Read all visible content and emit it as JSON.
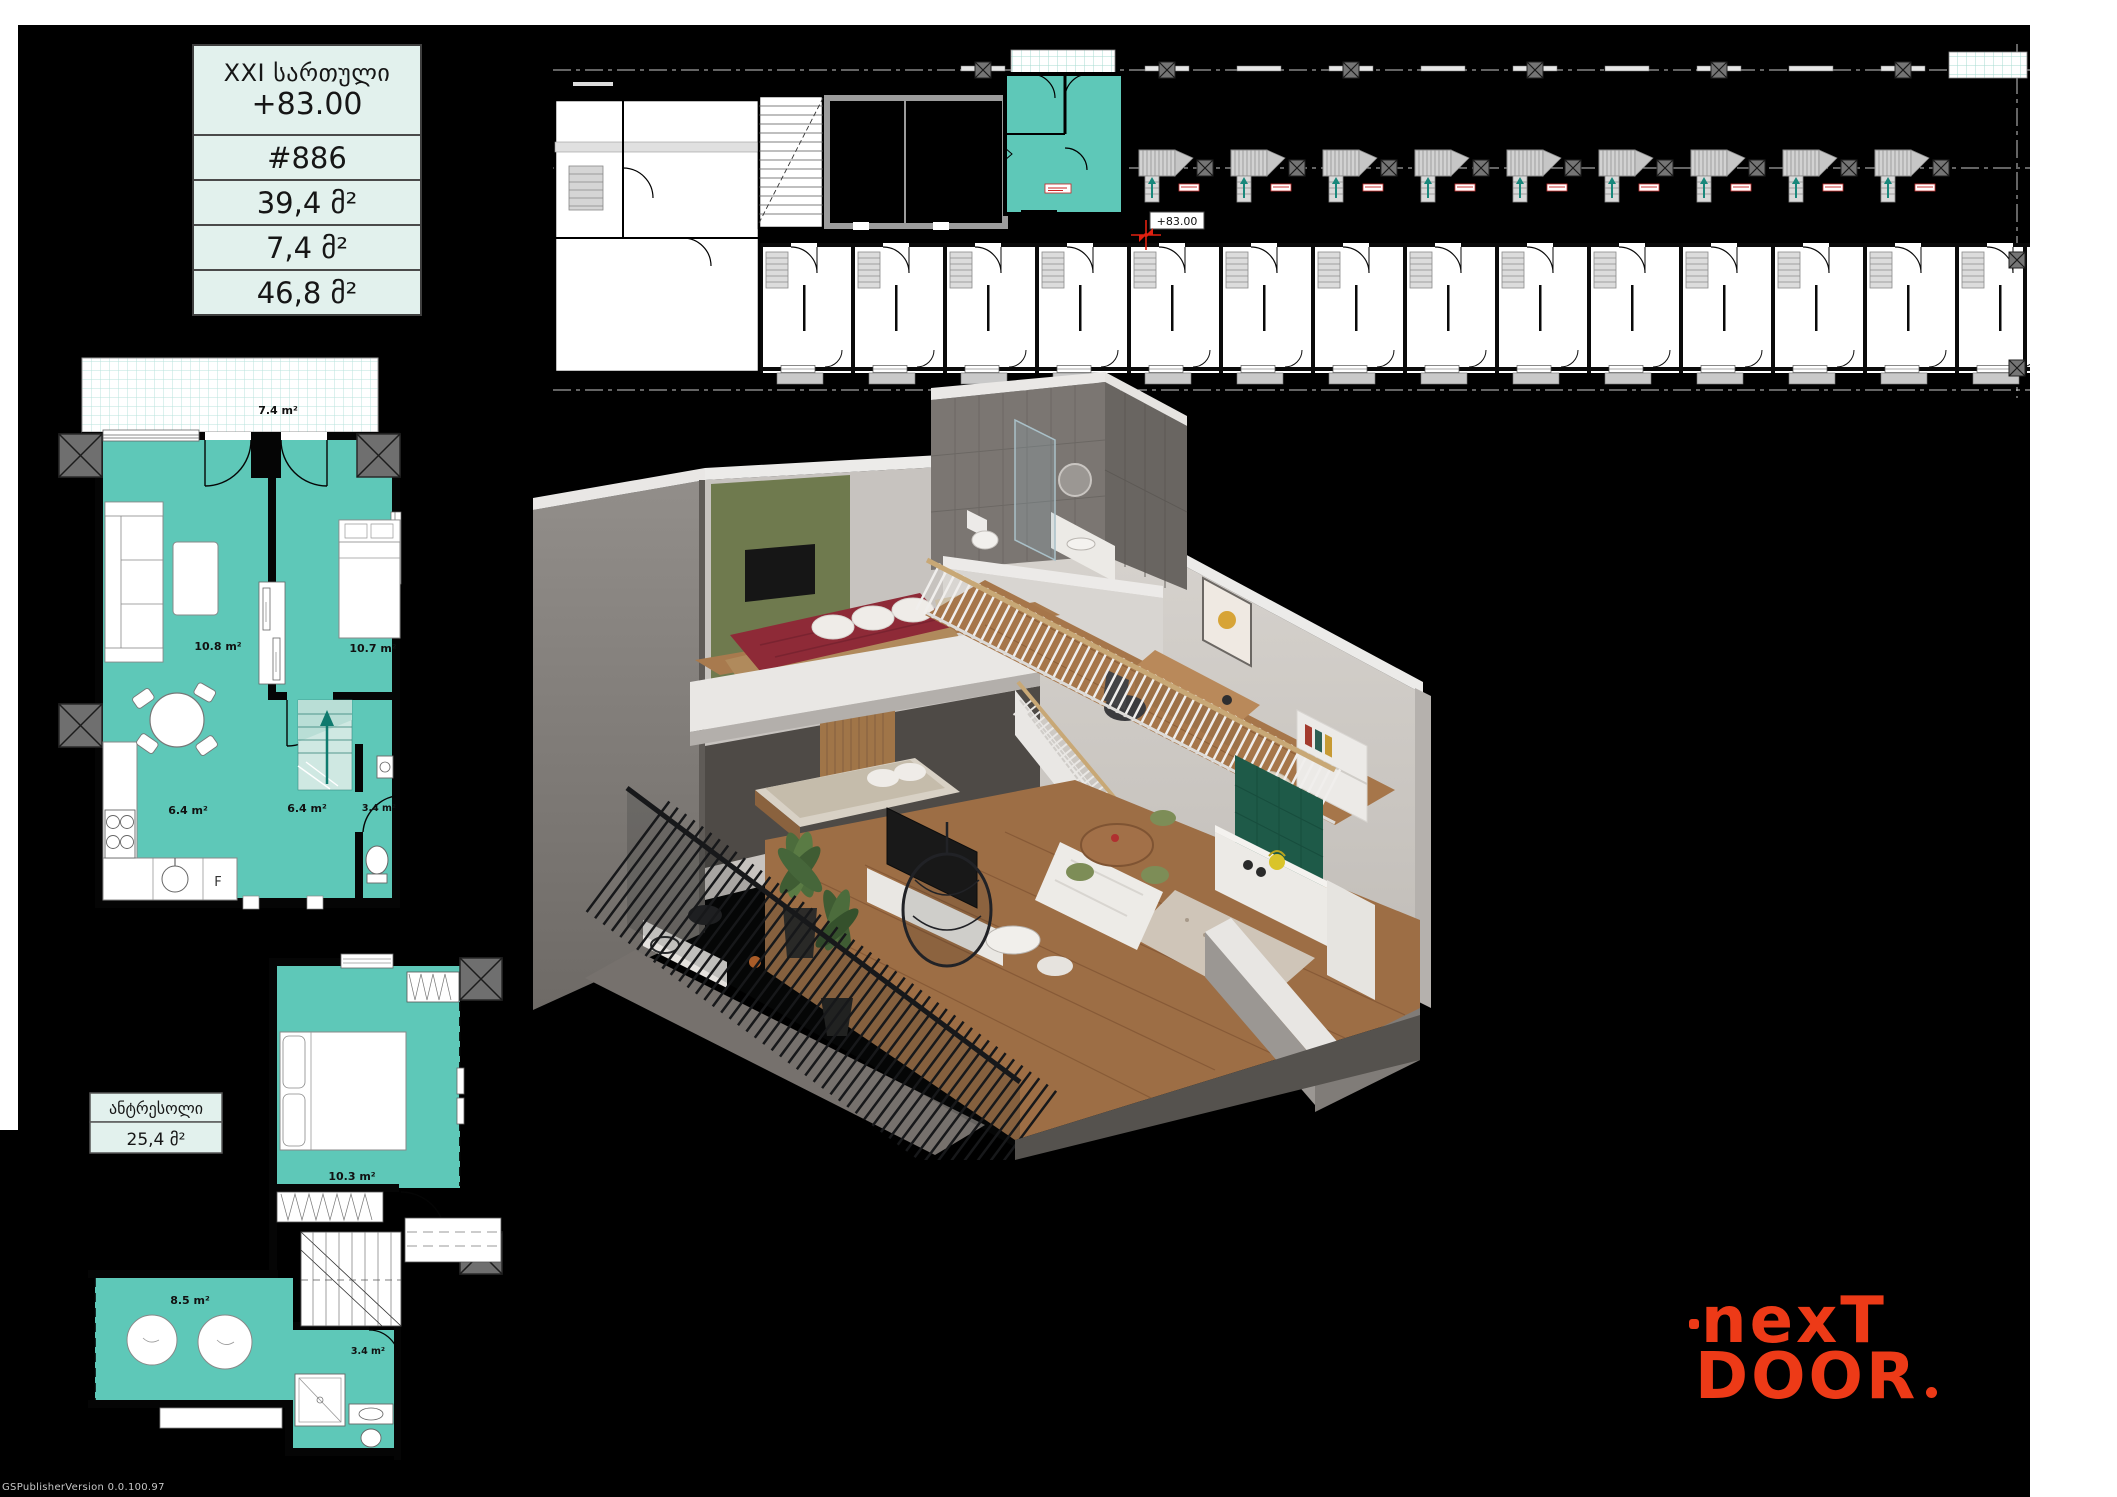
{
  "info_table": {
    "floor": "XXI სართული",
    "elevation": "+83.00",
    "apartment": "#886",
    "area_apartment": "39,4 მ²",
    "area_terrace": "7,4 მ²",
    "area_total": "46,8 მ²"
  },
  "building_plan": {
    "level_marker": "+83.00"
  },
  "level1_plan": {
    "terrace_area": "7.4 m²",
    "living_area": "10.8 m²",
    "bedroom_area": "10.7 m²",
    "kitchen_area": "6.4 m²",
    "hall_area": "6.4 m²",
    "bathroom_area": "3.4 m²",
    "fridge_label": "F"
  },
  "mezzanine_plan": {
    "title": "ანტრესოლი",
    "total_area": "25,4 მ²",
    "bedroom_area": "10.3 m²",
    "hall_area": "8.5 m²",
    "bathroom_area": "3.4 m²"
  },
  "logo": {
    "line1": "nexT",
    "line2": "DOOR"
  },
  "watermark": "GSPublisherVersion 0.0.100.97",
  "colors": {
    "unit_highlight": "#5EC8B8",
    "table_mint": "#E2F1ED",
    "logo_orange": "#ED3A17",
    "marker_red": "#E02010"
  }
}
